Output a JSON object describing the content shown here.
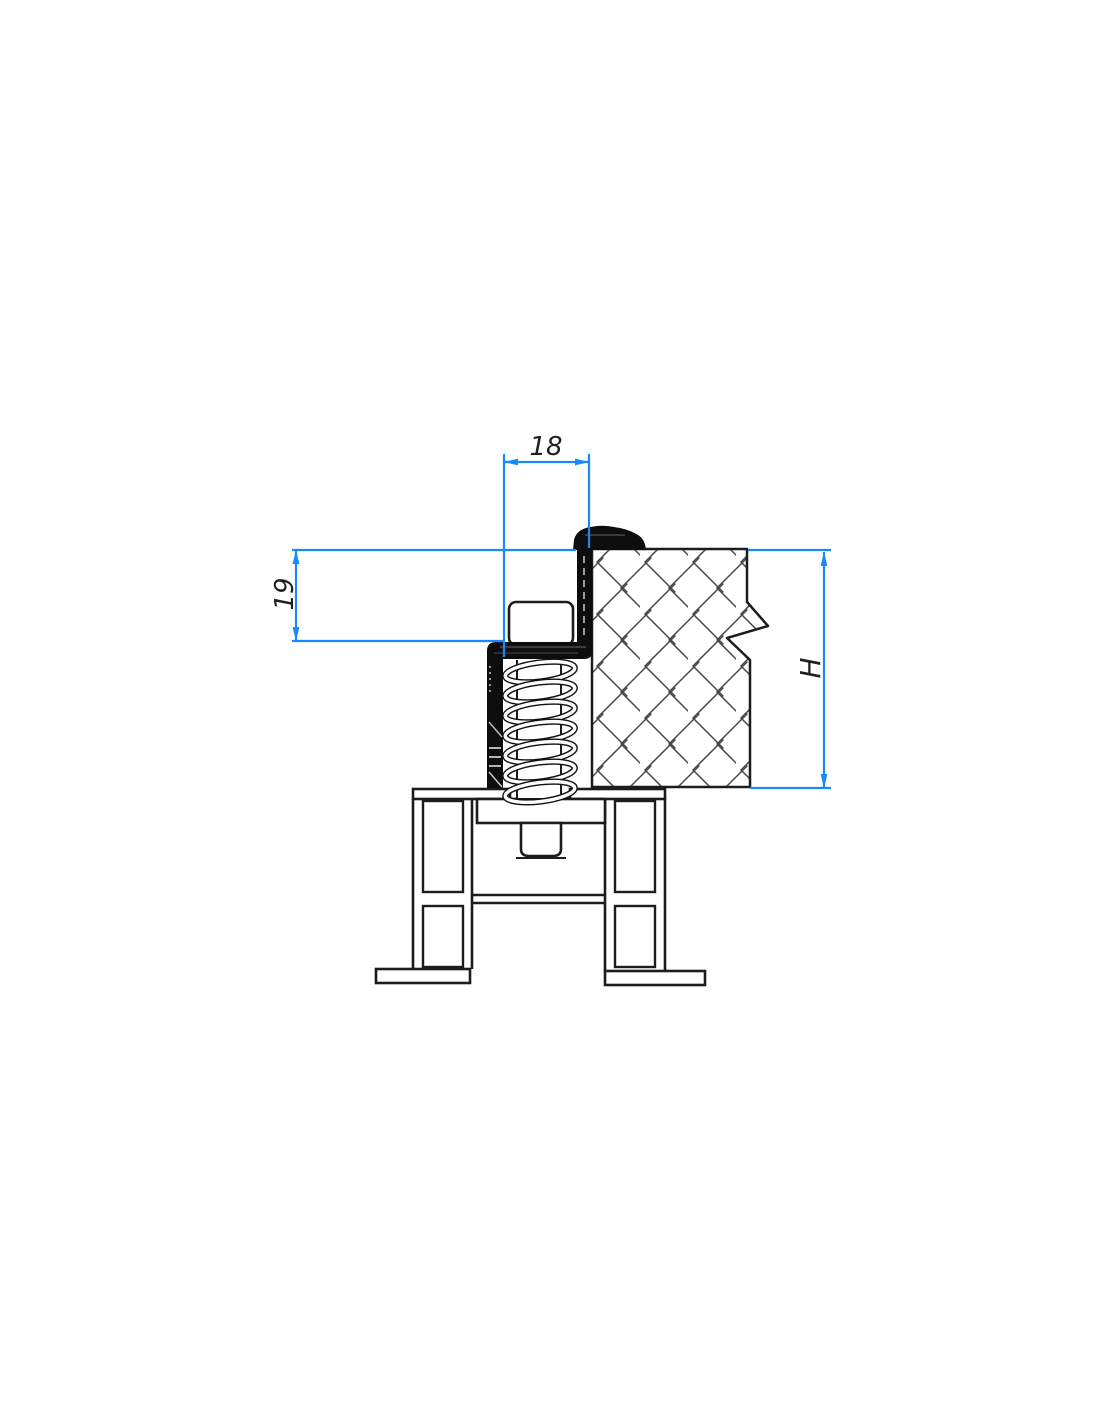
{
  "drawing": {
    "dim_width_label": "18",
    "dim_height_label": "19",
    "dim_panel_height_label": "H"
  },
  "colors": {
    "dimension": "#1789fc",
    "line": "#1c1c1c",
    "hatch": "#474747",
    "seal": "#0d0d0d",
    "text": "#1f1f1f",
    "background": "#ffffff"
  }
}
